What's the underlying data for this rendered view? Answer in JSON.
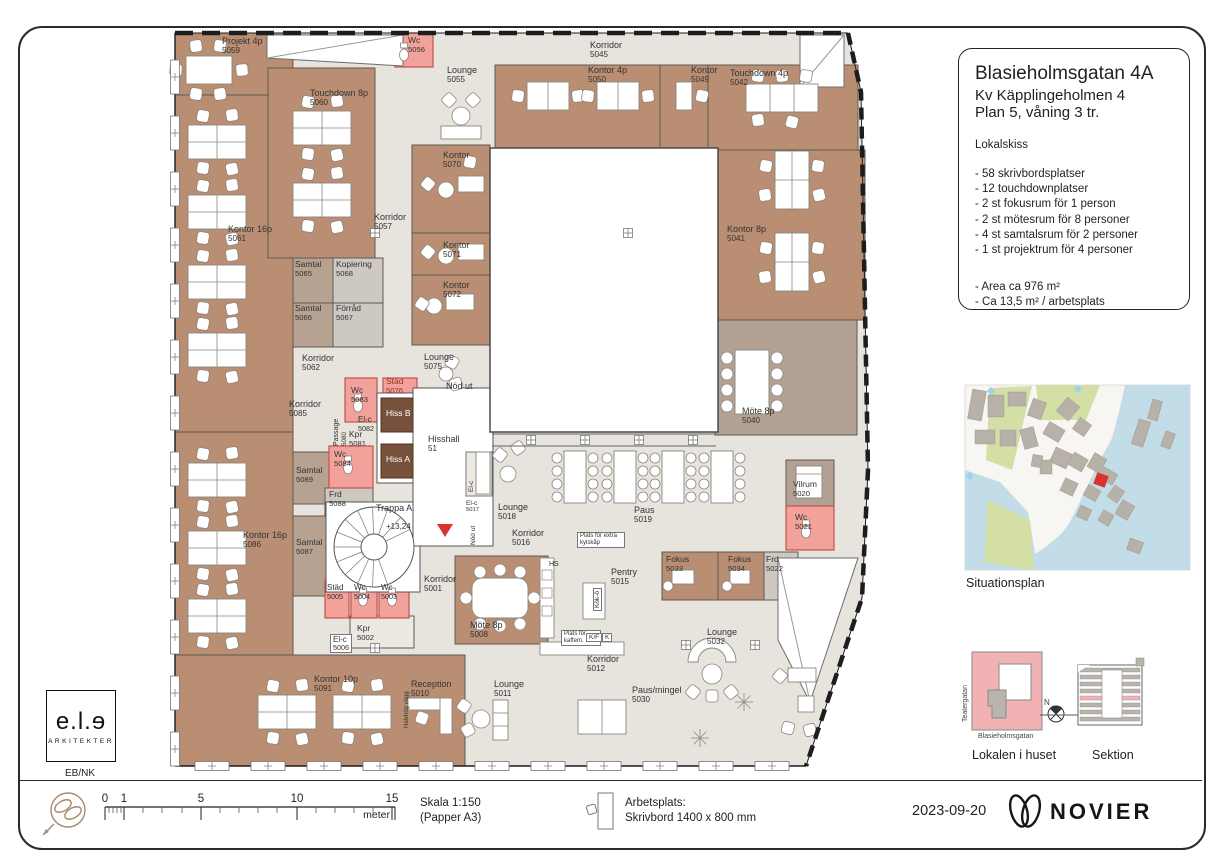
{
  "sheet": {
    "title_block": {
      "title": "Blasieholmsgatan 4A",
      "subtitle1": "Kv Käpplingeholmen 4",
      "subtitle2": "Plan 5, våning 3 tr.",
      "section_label": "Lokalskiss",
      "bullets": [
        "- 58 skrivbordsplatser",
        "- 12 touchdownplatser",
        "- 2 st fokusrum för 1 person",
        "- 2 st mötesrum för 8 personer",
        "- 4 st samtalsrum för 2 personer",
        "- 1 st projektrum för 4 personer"
      ],
      "area_lines": [
        "- Area ca 976 m²",
        "- Ca 13,5 m²  / arbetsplats"
      ]
    },
    "panels": {
      "situationsplan_caption": "Situationsplan",
      "lokalen_caption": "Lokalen i huset",
      "sektion_caption": "Sektion",
      "street_left": "Teatergatan",
      "street_bottom": "Blasieholmsgatan",
      "north_label": "N"
    },
    "footer": {
      "scale_ticks": [
        {
          "t": "0",
          "x": 105
        },
        {
          "t": "1",
          "x": 124
        },
        {
          "t": "5",
          "x": 201
        },
        {
          "t": "10",
          "x": 297
        },
        {
          "t": "15",
          "x": 392
        }
      ],
      "meter": "meter",
      "skala1": "Skala 1:150",
      "skala2": "(Papper A3)",
      "arbetsplats1": "Arbetsplats:",
      "arbetsplats2": "Skrivbord 1400 x 800 mm",
      "date": "2023-09-20",
      "brand": "NOVIER"
    },
    "architect": {
      "logo": "e.l.ɘ",
      "logo_sub": "ARKITEKTER",
      "initials": "EB/NK"
    }
  },
  "plan": {
    "labels": [
      {
        "t": "Projekt 4p",
        "n": "5059",
        "x": 222,
        "y": 36
      },
      {
        "t": "Wc",
        "n": "5056",
        "x": 408,
        "y": 36,
        "fs": 8.5
      },
      {
        "t": "Korridor",
        "n": "5045",
        "x": 590,
        "y": 40
      },
      {
        "t": "Lounge",
        "n": "5055",
        "x": 447,
        "y": 65
      },
      {
        "t": "Kontor 4p",
        "n": "5050",
        "x": 588,
        "y": 65
      },
      {
        "t": "Kontor",
        "n": "5049",
        "x": 691,
        "y": 65
      },
      {
        "t": "Touchdown 4p",
        "n": "5042",
        "x": 730,
        "y": 68
      },
      {
        "t": "Touchdown 8p",
        "n": "5060",
        "x": 310,
        "y": 88
      },
      {
        "t": "Kontor",
        "n": "5070",
        "x": 443,
        "y": 150
      },
      {
        "t": "Korridor",
        "n": "5057",
        "x": 374,
        "y": 212
      },
      {
        "t": "Kontor 16p",
        "n": "5061",
        "x": 228,
        "y": 224
      },
      {
        "t": "Kontor 8p",
        "n": "5041",
        "x": 727,
        "y": 224
      },
      {
        "t": "Kontor",
        "n": "5071",
        "x": 443,
        "y": 240
      },
      {
        "t": "Samtal",
        "n": "5065",
        "x": 295,
        "y": 260,
        "fs": 8.5
      },
      {
        "t": "Kopiering",
        "n": "5068",
        "x": 336,
        "y": 260,
        "fs": 8.5
      },
      {
        "t": "Kontor",
        "n": "5072",
        "x": 443,
        "y": 280
      },
      {
        "t": "Samtal",
        "n": "5066",
        "x": 295,
        "y": 304,
        "fs": 8.5
      },
      {
        "t": "Förråd",
        "n": "5067",
        "x": 336,
        "y": 304,
        "fs": 8.5
      },
      {
        "t": "Korridor",
        "n": "5062",
        "x": 302,
        "y": 353
      },
      {
        "t": "Lounge",
        "n": "5075",
        "x": 424,
        "y": 352
      },
      {
        "t": "Städ",
        "n": "5076",
        "x": 386,
        "y": 377,
        "fs": 8.5,
        "col": "#9c2b22"
      },
      {
        "t": "Nöd ut",
        "x": 446,
        "y": 381
      },
      {
        "t": "Wc",
        "n": "5083",
        "x": 351,
        "y": 386,
        "fs": 8.5
      },
      {
        "t": "Passage",
        "n": "5080",
        "x": 333,
        "y": 446,
        "v": 1,
        "fs": 7
      },
      {
        "t": "Korridor",
        "n": "5085",
        "x": 289,
        "y": 399
      },
      {
        "t": "Hiss B",
        "x": 386,
        "y": 409,
        "col": "#fff",
        "fs": 8.5
      },
      {
        "t": "El-c",
        "n": "5082",
        "x": 358,
        "y": 416,
        "fs": 8
      },
      {
        "t": "Kpr",
        "n": "5081",
        "x": 349,
        "y": 430,
        "fs": 8.5
      },
      {
        "t": "Hisshall",
        "n": "51",
        "x": 428,
        "y": 434
      },
      {
        "t": "Wc",
        "n": "5084",
        "x": 334,
        "y": 450,
        "fs": 8.5
      },
      {
        "t": "Hiss A",
        "x": 386,
        "y": 455,
        "col": "#fff",
        "fs": 8.5
      },
      {
        "t": "El-c",
        "x": 468,
        "y": 492,
        "v": 1,
        "fs": 6.5
      },
      {
        "t": "Samtal",
        "n": "5089",
        "x": 296,
        "y": 466,
        "fs": 8.5
      },
      {
        "t": "Möte 8p",
        "n": "5040",
        "x": 742,
        "y": 406
      },
      {
        "t": "Vilrum",
        "n": "5020",
        "x": 793,
        "y": 480,
        "fs": 8.5
      },
      {
        "t": "Frd",
        "n": "5088",
        "x": 329,
        "y": 490,
        "fs": 8.5
      },
      {
        "t": "Trappa A",
        "x": 376,
        "y": 503
      },
      {
        "t": "+13,24",
        "x": 386,
        "y": 523,
        "fs": 8
      },
      {
        "t": "Lounge",
        "n": "5018",
        "x": 498,
        "y": 502
      },
      {
        "t": "El-c",
        "n": "5017",
        "x": 466,
        "y": 500,
        "fs": 6.5
      },
      {
        "t": "Paus",
        "n": "5019",
        "x": 634,
        "y": 505
      },
      {
        "t": "Wc",
        "n": "5021",
        "x": 795,
        "y": 513,
        "fs": 8.5
      },
      {
        "t": "Nöd ut",
        "x": 470,
        "y": 545,
        "v": 1,
        "fs": 6.5
      },
      {
        "t": "Korridor",
        "n": "5016",
        "x": 512,
        "y": 528
      },
      {
        "t": "Kontor 16p",
        "n": "5086",
        "x": 243,
        "y": 530
      },
      {
        "t": "Samtal",
        "n": "5087",
        "x": 296,
        "y": 538,
        "fs": 8.5
      },
      {
        "t": "Plats för extra kylskåp",
        "x": 577,
        "y": 532,
        "box": 1,
        "fs": 6,
        "w": 42
      },
      {
        "t": "Fokus",
        "n": "5033",
        "x": 666,
        "y": 555,
        "fs": 8.5
      },
      {
        "t": "Fokus",
        "n": "5034",
        "x": 728,
        "y": 555,
        "fs": 8.5
      },
      {
        "t": "Frd",
        "n": "5022",
        "x": 766,
        "y": 555,
        "fs": 8.5
      },
      {
        "t": "HS",
        "x": 549,
        "y": 561,
        "fs": 7
      },
      {
        "t": "Pentry",
        "n": "5015",
        "x": 611,
        "y": 567
      },
      {
        "t": "Korridor",
        "n": "5001",
        "x": 424,
        "y": 574
      },
      {
        "t": "Städ",
        "n": "5005",
        "x": 327,
        "y": 584,
        "fs": 8
      },
      {
        "t": "Wc",
        "n": "5004",
        "x": 354,
        "y": 584,
        "fs": 8
      },
      {
        "t": "Wc",
        "n": "5003",
        "x": 381,
        "y": 584,
        "fs": 8
      },
      {
        "t": "Kök-ö",
        "x": 593,
        "y": 611,
        "v": 1,
        "fs": 6.5,
        "box": 1
      },
      {
        "t": "Möte 8p",
        "n": "5008",
        "x": 470,
        "y": 620
      },
      {
        "t": "Kpr",
        "n": "5002",
        "x": 357,
        "y": 624,
        "fs": 8.5
      },
      {
        "t": "Lounge",
        "n": "5032",
        "x": 707,
        "y": 627
      },
      {
        "t": "El-c",
        "n": "5006",
        "x": 330,
        "y": 634,
        "fs": 8,
        "box": 1
      },
      {
        "t": "Plats för kaffem.",
        "x": 561,
        "y": 630,
        "box": 1,
        "fs": 6,
        "w": 34
      },
      {
        "t": "K/F",
        "x": 586,
        "y": 633,
        "box": 1,
        "fs": 6.5
      },
      {
        "t": "K",
        "x": 602,
        "y": 633,
        "box": 1,
        "fs": 6.5
      },
      {
        "t": "Korridor",
        "n": "5012",
        "x": 587,
        "y": 654
      },
      {
        "t": "Kontor 10p",
        "n": "5091",
        "x": 314,
        "y": 674
      },
      {
        "t": "Reception",
        "n": "5010",
        "x": 411,
        "y": 679
      },
      {
        "t": "Lounge",
        "n": "5011",
        "x": 494,
        "y": 679
      },
      {
        "t": "Paus/mingel",
        "n": "5030",
        "x": 632,
        "y": 685
      },
      {
        "t": "Halvhög vägg",
        "x": 404,
        "y": 728,
        "v": 1,
        "fs": 6
      }
    ]
  },
  "colors": {
    "office": "#b98e72",
    "meeting": "#b3a294",
    "samtal": "#b7a190",
    "storage": "#cdc8c1",
    "wet": "#f2a19b",
    "wet_border": "#c0554e",
    "elevator": "#77513b",
    "floor": "#e7e3dd",
    "wall": "#5f5a54",
    "accent_red": "#d8332c",
    "water": "#c2dde8",
    "park": "#d3dfa5",
    "building_gray": "#b7b1a8",
    "pink": "#f0b2b2"
  }
}
